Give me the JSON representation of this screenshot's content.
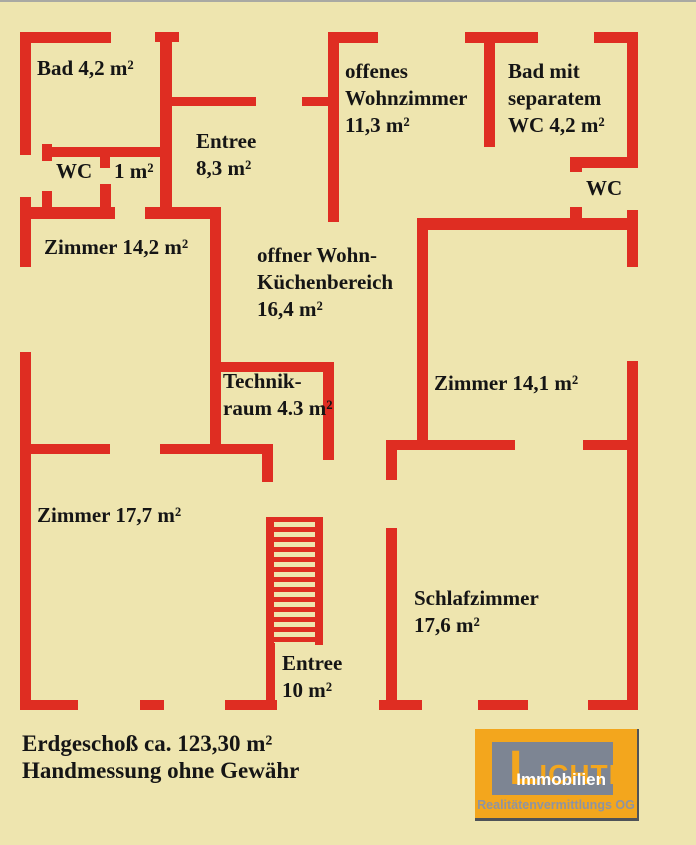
{
  "rooms": {
    "bad": "Bad 4,2 m²",
    "wc_left": "WC",
    "wc_left_area": "1 m²",
    "entree_upper": "Entree\n8,3 m²",
    "wohnzimmer": "offenes\nWohnzimmer\n11,3 m²",
    "bad_sep_wc": "Bad mit\nseparatem\nWC 4,2 m²",
    "wc_right": "WC",
    "zimmer_142": "Zimmer 14,2 m²",
    "kuechenbereich": "offner Wohn-\nKüchenbereich\n16,4 m²",
    "zimmer_141": "Zimmer 14,1 m²",
    "technikraum": "Technik-\nraum 4.3 m²",
    "zimmer_177": "Zimmer 17,7 m²",
    "schlafzimmer": "Schlafzimmer\n17,6 m²",
    "entree_lower": "Entree\n10 m²"
  },
  "footer": {
    "area_line": "Erdgeschoß ca. 123,30 m²",
    "disclaimer_line": "Handmessung ohne Gewähr"
  },
  "logo": {
    "name": "LICHTL",
    "subtitle": "Immobilien",
    "tagline": "Realitätenvermittlungs OG"
  },
  "colors": {
    "background": "#eee5af",
    "wall_red": "#df2d22",
    "text": "#151515",
    "logo_orange": "#f3a61d",
    "logo_gray_box": "#7d8593",
    "logo_tagline": "#8d94a3"
  }
}
